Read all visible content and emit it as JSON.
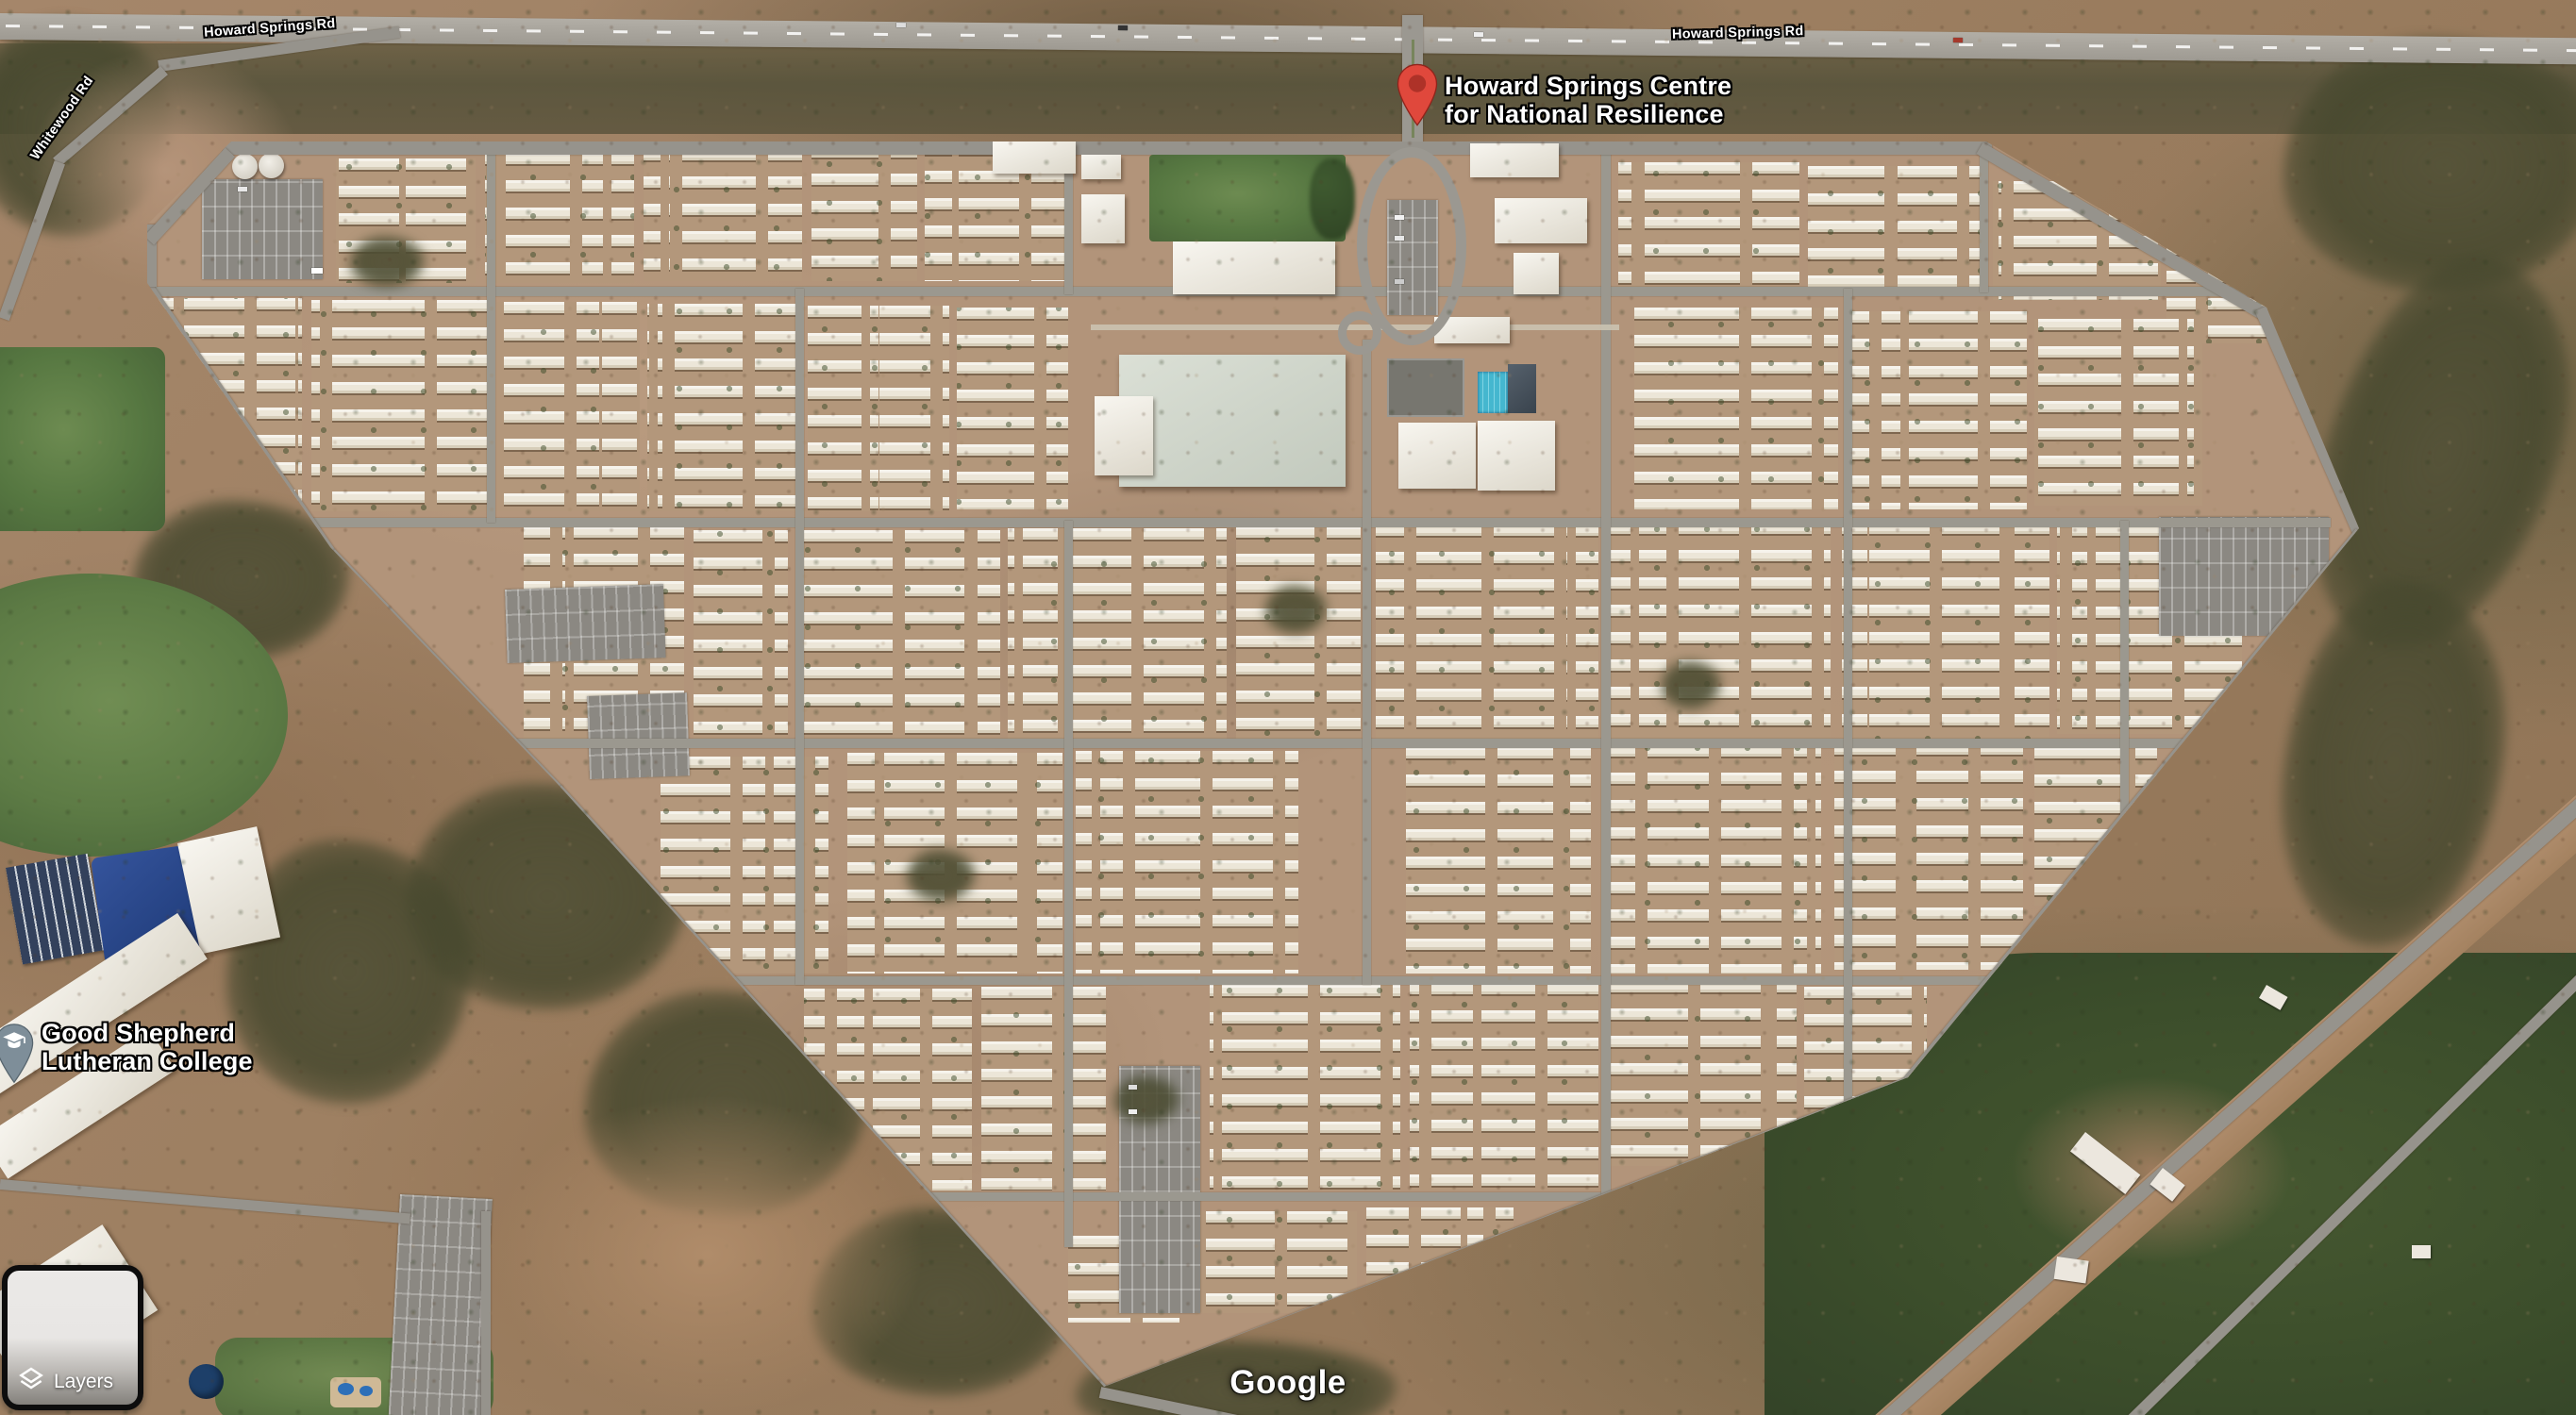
{
  "map": {
    "pois": [
      {
        "lines": [
          "Howard Springs Centre",
          "for National Resilience"
        ],
        "marker": "red-place-pin"
      },
      {
        "lines": [
          "Good Shepherd",
          "Lutheran College"
        ],
        "marker": "school-pin"
      }
    ],
    "road_labels": [
      {
        "text": "Howard Springs Rd"
      },
      {
        "text": "Howard Springs Rd"
      },
      {
        "text": "Whitewood Rd"
      }
    ]
  },
  "ui": {
    "layers_button": "Layers",
    "watermark": "Google"
  },
  "colors": {
    "pin_red": "#E0483C",
    "pin_red_inner": "#AE3228",
    "pin_school_gray": "#7E8E99",
    "road_gray": "#96938C",
    "dirt": "#A98A69",
    "scrub_green": "#4B5434",
    "field_green": "#4F7339",
    "pool_blue": "#45B7CF",
    "unit_roof_white": "#F0ECE2"
  }
}
